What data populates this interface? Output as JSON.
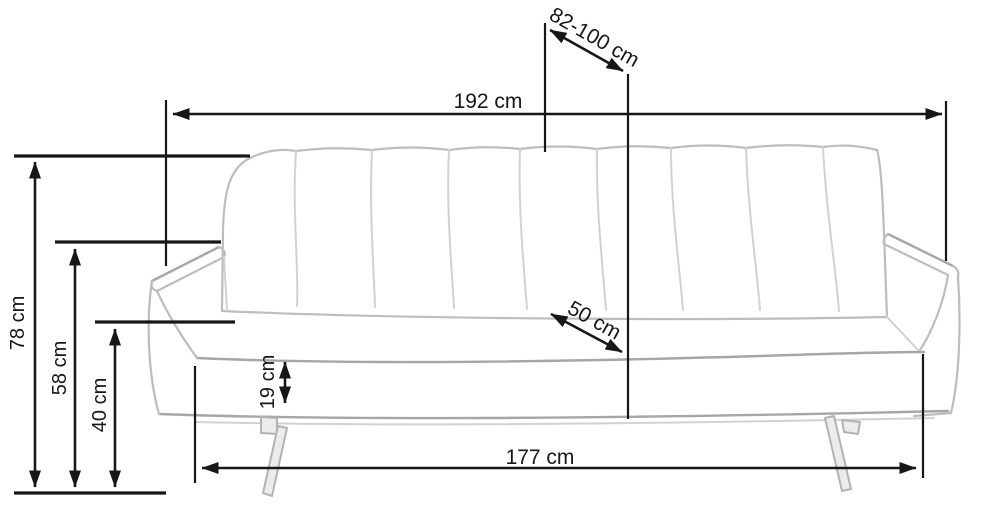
{
  "figure": {
    "type": "furniture-dimension-diagram",
    "subject": "sofa",
    "unit": "cm",
    "colors": {
      "background": "#ffffff",
      "dimension_lines": "#171717",
      "sketch_lines": "#bdbdbd"
    },
    "dimensions": {
      "overall_width": {
        "label": "192 cm",
        "value": 192,
        "orientation": "horizontal-top"
      },
      "depth_range": {
        "label": "82-100 cm",
        "min": 82,
        "max": 100,
        "orientation": "diagonal-top"
      },
      "overall_height": {
        "label": "78 cm",
        "value": 78,
        "orientation": "vertical-left"
      },
      "armrest_height": {
        "label": "58 cm",
        "value": 58,
        "orientation": "vertical-left"
      },
      "seat_height": {
        "label": "40 cm",
        "value": 40,
        "orientation": "vertical-left"
      },
      "seat_edge_height": {
        "label": "19 cm",
        "value": 19,
        "orientation": "vertical-front"
      },
      "base_width": {
        "label": "177 cm",
        "value": 177,
        "orientation": "horizontal-bottom"
      },
      "seat_depth": {
        "label": "50 cm",
        "value": 50,
        "orientation": "diagonal-seat"
      }
    }
  }
}
